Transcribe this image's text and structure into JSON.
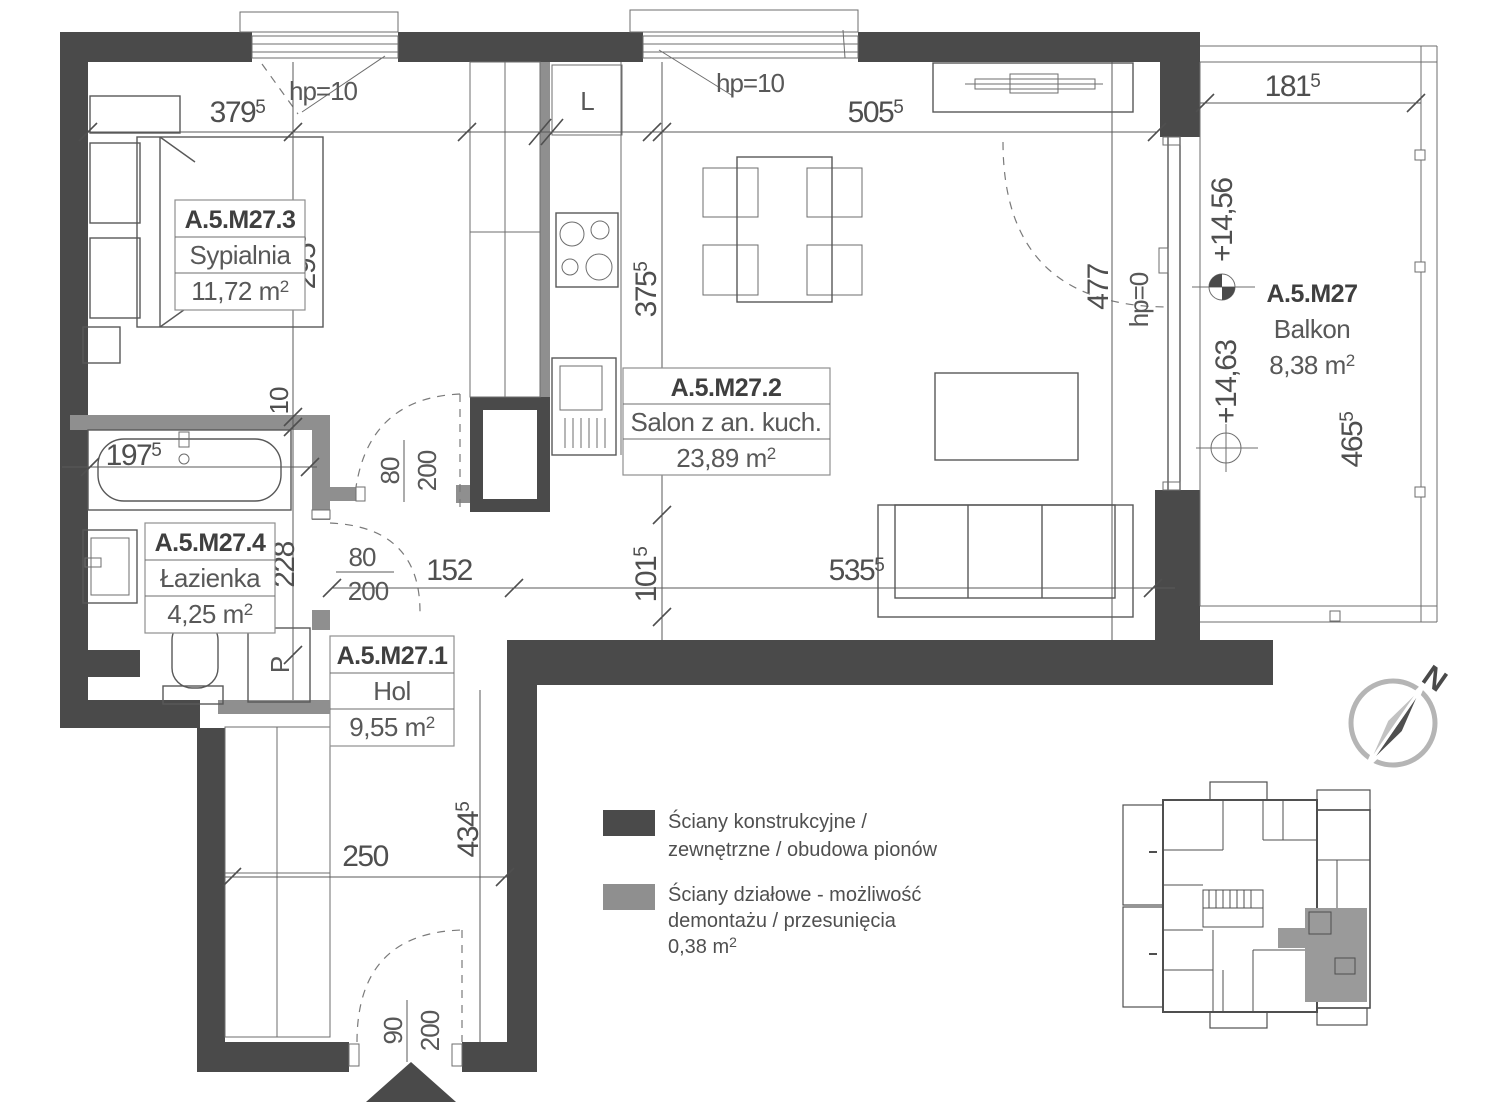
{
  "rooms": [
    {
      "id": "A.5.M27.3",
      "name": "Sypialnia",
      "area": "11,72 m",
      "area_sup": "2"
    },
    {
      "id": "A.5.M27.2",
      "name": "Salon z an. kuch.",
      "area": "23,89 m",
      "area_sup": "2"
    },
    {
      "id": "A.5.M27.4",
      "name": "Łazienka",
      "area": "4,25 m",
      "area_sup": "2"
    },
    {
      "id": "A.5.M27.1",
      "name": "Hol",
      "area": "9,55 m",
      "area_sup": "2"
    },
    {
      "id": "A.5.M27",
      "name": "Balkon",
      "area": "8,38 m",
      "area_sup": "2"
    }
  ],
  "dims": {
    "d379": {
      "main": "379",
      "sup": "5"
    },
    "d505": {
      "main": "505",
      "sup": "5"
    },
    "d295": {
      "main": "295",
      "sup": "5"
    },
    "d375": {
      "main": "375",
      "sup": "5"
    },
    "d101": {
      "main": "101",
      "sup": "5"
    },
    "d152": {
      "main": "152",
      "sup": ""
    },
    "d535": {
      "main": "535",
      "sup": "5"
    },
    "d197": {
      "main": "197",
      "sup": "5"
    },
    "d228": {
      "main": "228",
      "sup": ""
    },
    "d10": {
      "main": "10",
      "sup": ""
    },
    "d250": {
      "main": "250",
      "sup": ""
    },
    "d434": {
      "main": "434",
      "sup": "5"
    },
    "d181": {
      "main": "181",
      "sup": "5"
    },
    "d465": {
      "main": "465",
      "sup": "5"
    },
    "d477": {
      "main": "477",
      "sup": ""
    }
  },
  "doors": {
    "hall": {
      "w": "80",
      "h": "200"
    },
    "bath": {
      "w": "80",
      "h": "200"
    },
    "entry": {
      "w": "90",
      "h": "200"
    }
  },
  "openings": {
    "bedroom_window": "hp=10",
    "salon_window": "hp=10",
    "balcony_door": "hp=0"
  },
  "levels": {
    "upper": "+14,56",
    "lower": "+14,63"
  },
  "fixtures": {
    "fridge": "L",
    "washer": "P"
  },
  "legend": {
    "wall_line1": "Ściany konstrukcyjne /",
    "wall_line2": "zewnętrzne / obudowa pionów",
    "partition_line1": "Ściany działowe - możliwość",
    "partition_line2": "demontażu / przesunięcia",
    "partition_area": "0,38 m",
    "partition_area_sup": "2"
  },
  "compass": {
    "north": "N"
  },
  "colors": {
    "wall": "#4a4a4a",
    "partition": "#8f8f8f",
    "mini_highlight": "#9a9a9a"
  }
}
